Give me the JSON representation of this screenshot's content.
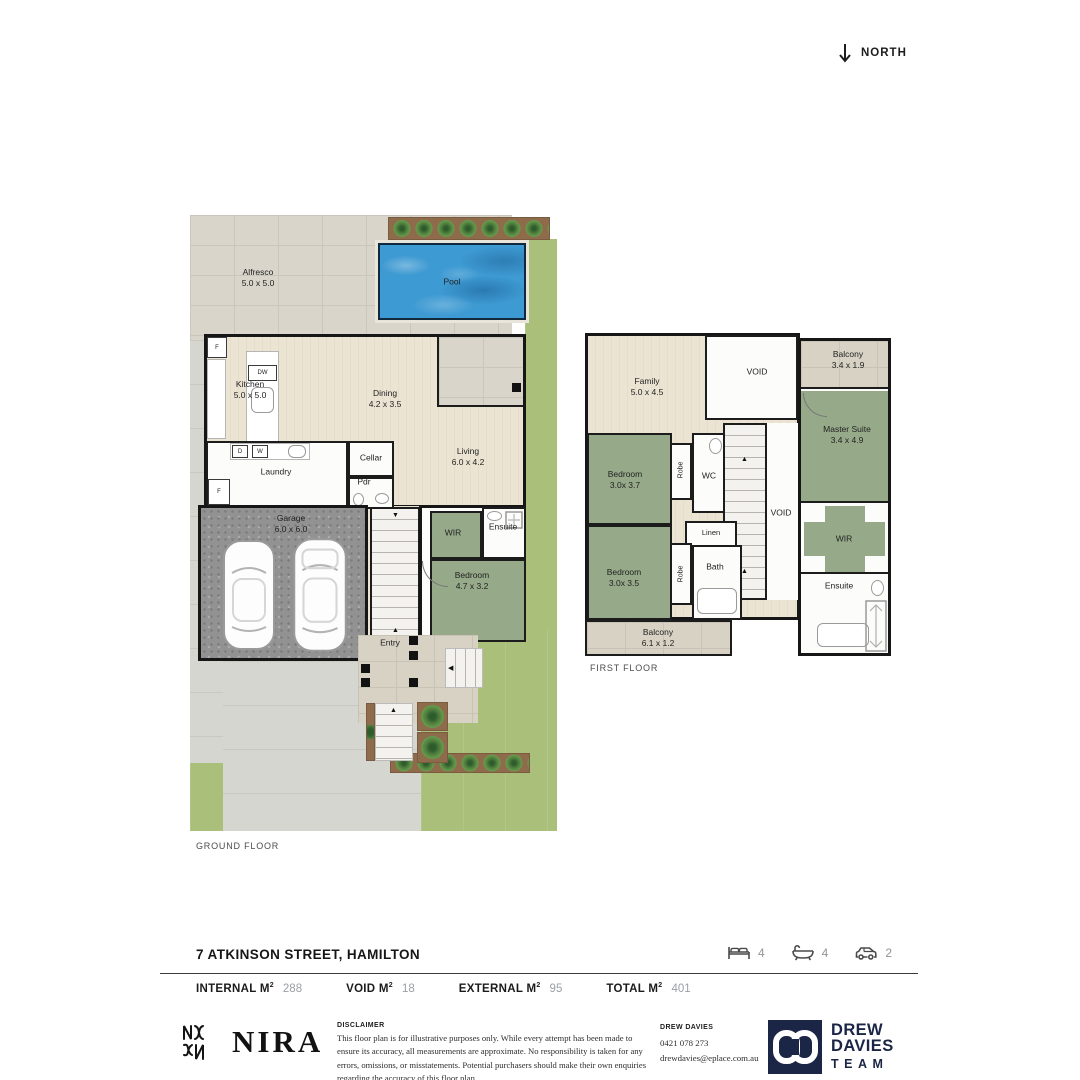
{
  "north_label": "NORTH",
  "floors": {
    "ground": {
      "label": "GROUND FLOOR",
      "rooms": {
        "alfresco": {
          "name": "Alfresco",
          "dims": "5.0 x 5.0"
        },
        "pool": {
          "name": "Pool"
        },
        "kitchen": {
          "name": "Kitchen",
          "dims": "5.0 x 5.0"
        },
        "dining": {
          "name": "Dining",
          "dims": "4.2 x 3.5"
        },
        "living": {
          "name": "Living",
          "dims": "6.0 x 4.2"
        },
        "laundry": {
          "name": "Laundry"
        },
        "cellar": {
          "name": "Cellar"
        },
        "pdr": {
          "name": "Pdr"
        },
        "garage": {
          "name": "Garage",
          "dims": "6.0 x 6.0"
        },
        "wir": {
          "name": "WIR"
        },
        "ensuite": {
          "name": "Ensuite"
        },
        "bedroom": {
          "name": "Bedroom",
          "dims": "4.7 x 3.2"
        },
        "entry": {
          "name": "Entry"
        }
      },
      "appliances": {
        "fridge": "F",
        "dishwasher": "DW",
        "dryer": "D",
        "washer": "W",
        "laundry_fridge": "F"
      }
    },
    "first": {
      "label": "FIRST FLOOR",
      "rooms": {
        "family": {
          "name": "Family",
          "dims": "5.0 x 4.5"
        },
        "void_top": {
          "name": "VOID"
        },
        "balcony_top": {
          "name": "Balcony",
          "dims": "3.4 x 1.9"
        },
        "master": {
          "name": "Master Suite",
          "dims": "3.4 x 4.9"
        },
        "bedroom1": {
          "name": "Bedroom",
          "dims": "3.0x 3.7"
        },
        "robe1": {
          "name": "Robe"
        },
        "wc": {
          "name": "WC"
        },
        "void_mid": {
          "name": "VOID"
        },
        "linen": {
          "name": "Linen"
        },
        "bedroom2": {
          "name": "Bedroom",
          "dims": "3.0x 3.5"
        },
        "robe2": {
          "name": "Robe"
        },
        "bath": {
          "name": "Bath"
        },
        "balcony_bottom": {
          "name": "Balcony",
          "dims": "6.1 x 1.2"
        },
        "wir": {
          "name": "WIR"
        },
        "ensuite": {
          "name": "Ensuite"
        }
      }
    }
  },
  "footer": {
    "address": "7 ATKINSON STREET, HAMILTON",
    "features": [
      {
        "icon": "bed-icon",
        "count": "4"
      },
      {
        "icon": "bath-icon",
        "count": "4"
      },
      {
        "icon": "car-icon",
        "count": "2"
      }
    ],
    "stats": [
      {
        "label": "INTERNAL M",
        "sup": "2",
        "value": "288"
      },
      {
        "label": "VOID M",
        "sup": "2",
        "value": "18"
      },
      {
        "label": "EXTERNAL M",
        "sup": "2",
        "value": "95"
      },
      {
        "label": "TOTAL M",
        "sup": "2",
        "value": "401"
      }
    ],
    "brand": {
      "name": "NIRA"
    },
    "disclaimer": {
      "title": "DISCLAIMER",
      "body": "This floor plan is for illustrative purposes only. While every attempt has been made to ensure its accuracy, all measurements are approximate. No responsibility is taken for any errors, omissions, or misstatements. Potential purchasers should make their own enquiries regarding the accuracy of this floor plan."
    },
    "agent": {
      "name": "DREW DAVIES",
      "phone": "0421 078 273",
      "email": "drewdavies@eplace.com.au"
    },
    "team_logo": {
      "line1": "DREW",
      "line2": "DAVIES",
      "line3": "TEAM"
    }
  },
  "colors": {
    "lawn": "#a9bf7a",
    "timber": "#eae2d2",
    "bedroom_green": "#96aa89",
    "paving": "#d9d5cb",
    "pool_blue": "#3e9ad2",
    "wall": "#1c1c1c",
    "brand_navy": "#1b2546",
    "text_dark": "#1c1c1c",
    "text_gray": "#9aa0a4"
  }
}
